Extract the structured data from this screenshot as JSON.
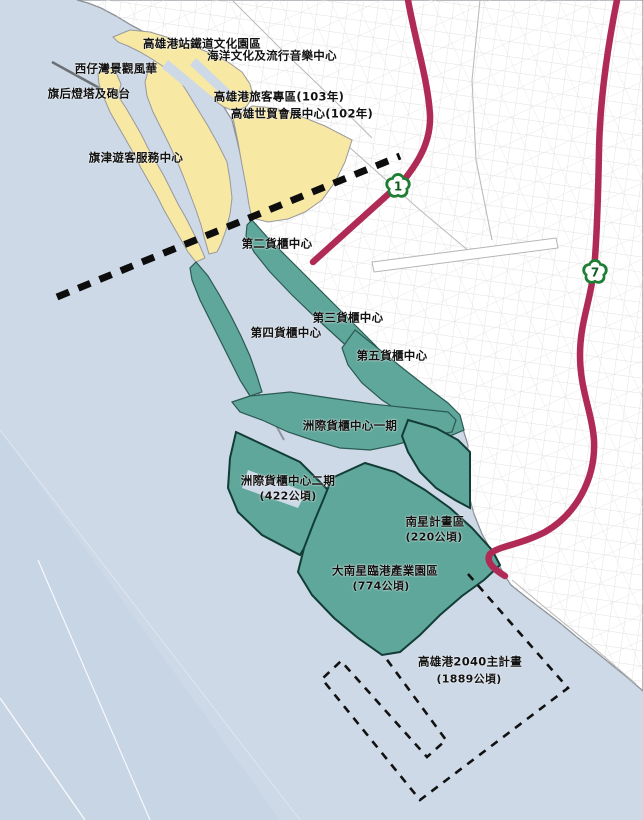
{
  "map_labels": {
    "railway_culture_park": "高雄港站鐵道文化園區",
    "marine_pop_music_center": "海洋文化及流行音樂中心",
    "sizihwan_scenic": "西仔灣景觀風華",
    "cihou_lighthouse_fort": "旗后燈塔及砲台",
    "port_passenger_zone": "高雄港旅客專區(103年)",
    "world_trade_exhibition_center": "高雄世貿會展中心(102年)",
    "cijin_visitor_center": "旗津遊客服務中心",
    "container_terminal_2": "第二貨櫃中心",
    "container_terminal_3": "第三貨櫃中心",
    "container_terminal_4": "第四貨櫃中心",
    "container_terminal_5": "第五貨櫃中心",
    "intercontinental_phase1": "洲際貨櫃中心一期",
    "intercontinental_phase2": "洲際貨櫃中心二期",
    "intercontinental_phase2_area": "(422公頃)",
    "nanxing_project_zone": "南星計畫區",
    "nanxing_project_zone_area": "(220公頃)",
    "greater_nanxing_industrial_park": "大南星臨港產業園區",
    "greater_nanxing_industrial_park_area": "(774公頃)",
    "master_plan_2040": "高雄港2040主計畫",
    "master_plan_2040_area": "(1889公頃)"
  },
  "highway_shields": {
    "national_highway_1": "1",
    "national_highway_7": "7"
  },
  "colors": {
    "sea": "#cdd9e7",
    "land": "#ffffff",
    "heritage_zone_yellow": "#f7e8a4",
    "port_zone_teal": "#5fa79b",
    "highway_crimson": "#b02a56",
    "shield_green": "#1e7e34",
    "boundary_black": "#111111"
  }
}
